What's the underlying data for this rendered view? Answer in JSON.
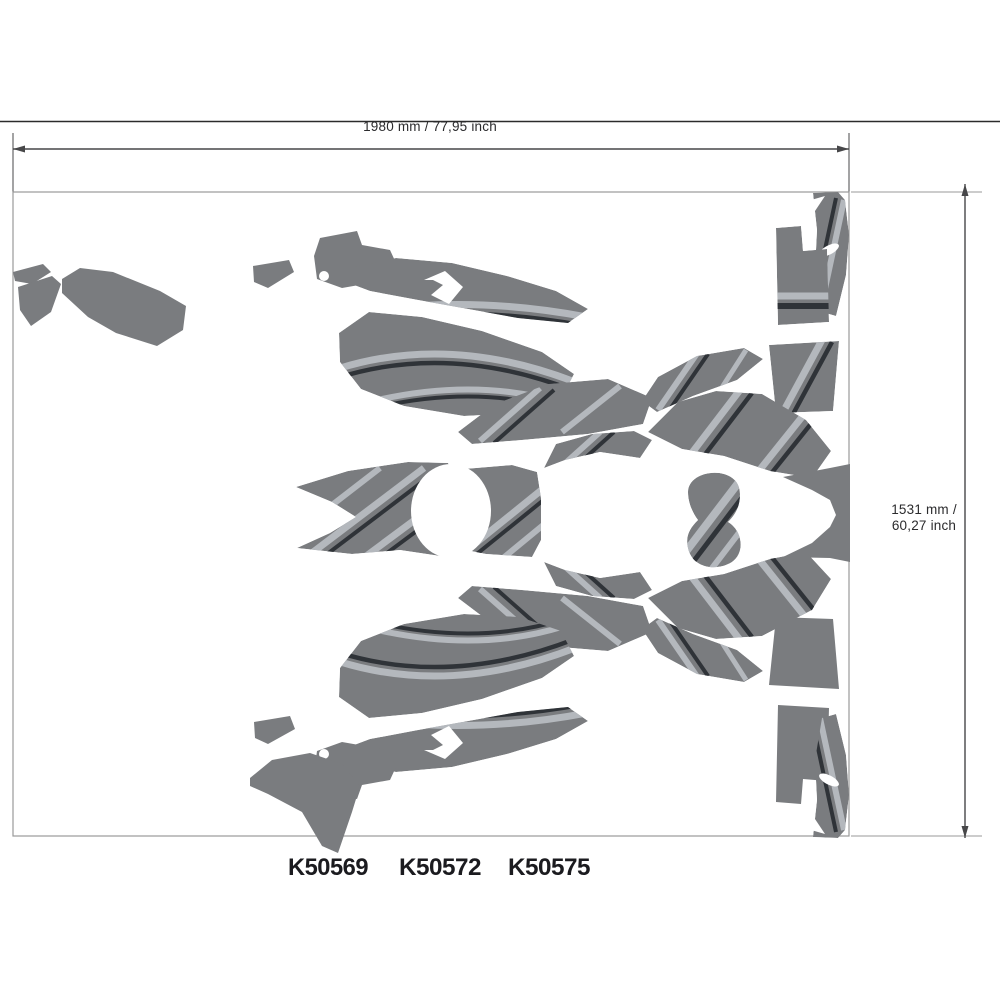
{
  "dimensions": {
    "width_label": "1980 mm / 77,95 inch",
    "height_label_line1": "1531 mm /",
    "height_label_line2": "60,27 inch"
  },
  "part_numbers": [
    "K50569",
    "K50572",
    "K50575"
  ],
  "colors": {
    "piece": "#7a7c7f",
    "stripe-light": "#b4b8bd",
    "stripe-dark": "#2f3338",
    "dim": "#474749",
    "border": "#9a9a9a",
    "rule": "#2b2b2b",
    "text": "#2b2b2d",
    "text-strong": "#1b1b1f"
  }
}
